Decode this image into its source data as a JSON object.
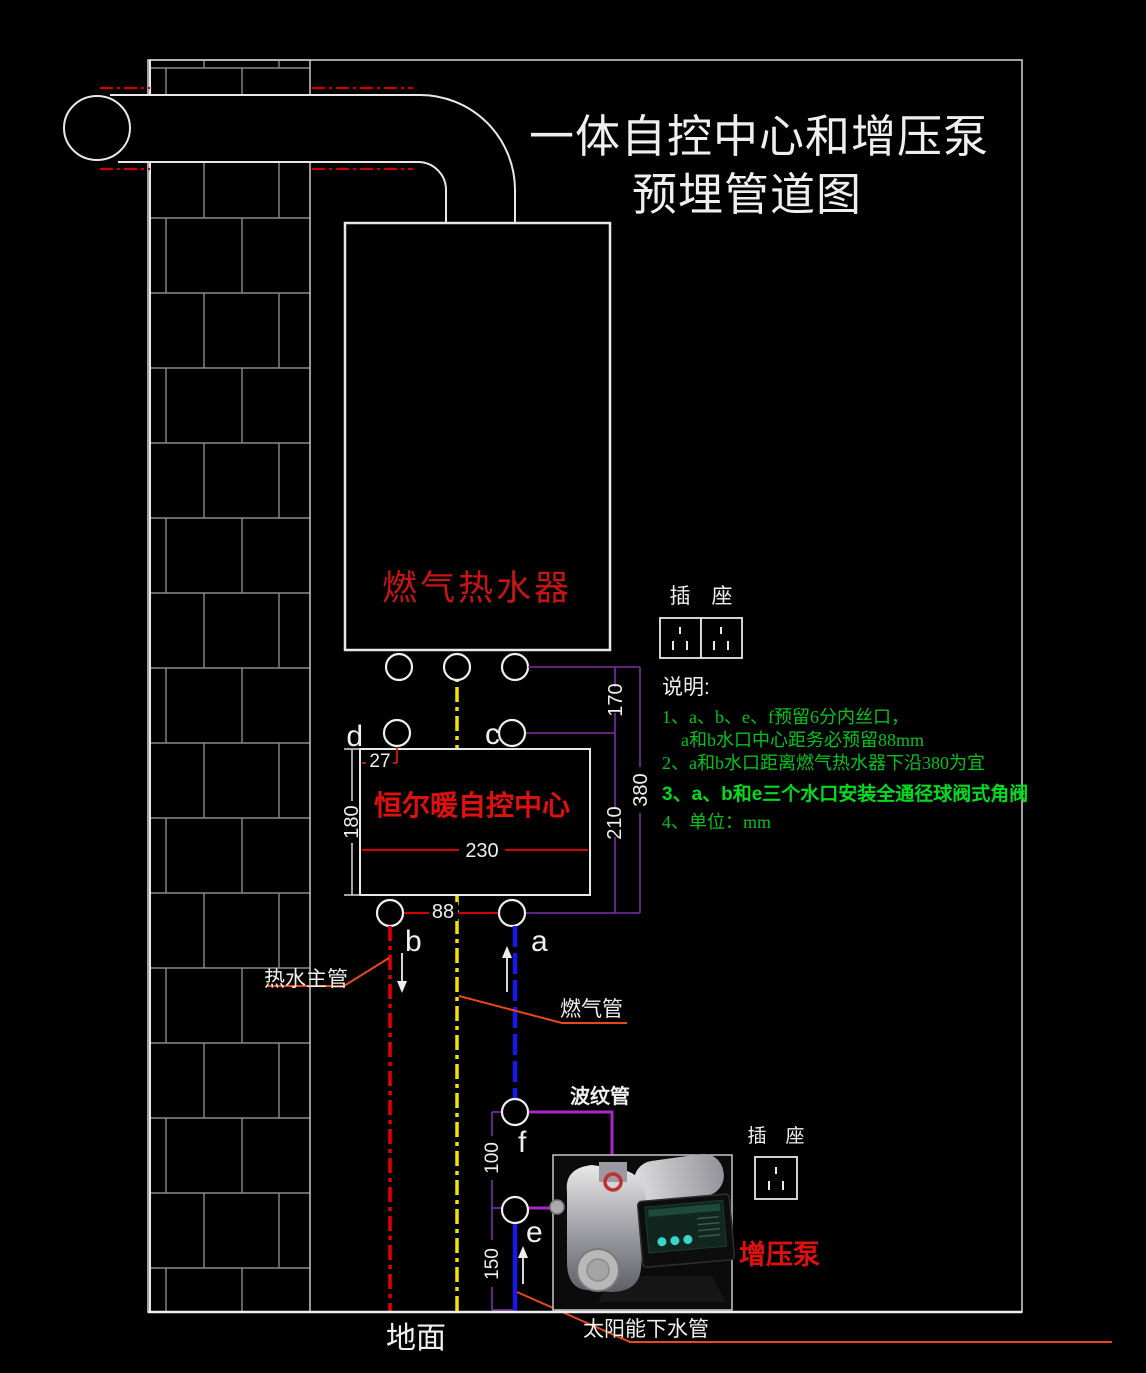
{
  "title": {
    "line1": "一体自控中心和增压泵",
    "line2": "预埋管道图"
  },
  "heater": {
    "label": "燃气热水器"
  },
  "control_center": {
    "label": "恒尔暖自控中心"
  },
  "pump": {
    "label": "增压泵"
  },
  "sockets": {
    "upper": "插　座",
    "lower": "插　座"
  },
  "pipes": {
    "hot_water_main": "热水主管",
    "gas": "燃气管",
    "corrugated": "波纹管",
    "solar_down": "太阳能下水管"
  },
  "ground_label": "地面",
  "ports": {
    "a": "a",
    "b": "b",
    "c": "c",
    "d": "d",
    "e": "e",
    "f": "f"
  },
  "dims": {
    "w27": "27",
    "h180": "180",
    "w230": "230",
    "w88": "88",
    "h170": "170",
    "h210": "210",
    "h380": "380",
    "h100": "100",
    "h150": "150"
  },
  "notes": {
    "heading": "说明:",
    "line1": "1、a、b、e、f预留6分内丝口，",
    "line2": "a和b水口中心距务必预留88mm",
    "line3": "2、a和b水口距离燃气热水器下沿380为宜",
    "line4": "3、a、b和e三个水口安装全通径球阀式角阀",
    "line5": "4、单位：mm"
  },
  "colors": {
    "background": "#000000",
    "line_white": "#E8E8E8",
    "pipe_red": "#E60000",
    "pipe_yellow": "#F2E400",
    "pipe_blue": "#1818E8",
    "dim_purple": "#7B30A8",
    "connector_magenta": "#AA28C8",
    "leader_orange": "#E8481C",
    "note_green": "#00C41E",
    "label_red": "#E01010",
    "wall_gray": "#8A8A8A"
  }
}
